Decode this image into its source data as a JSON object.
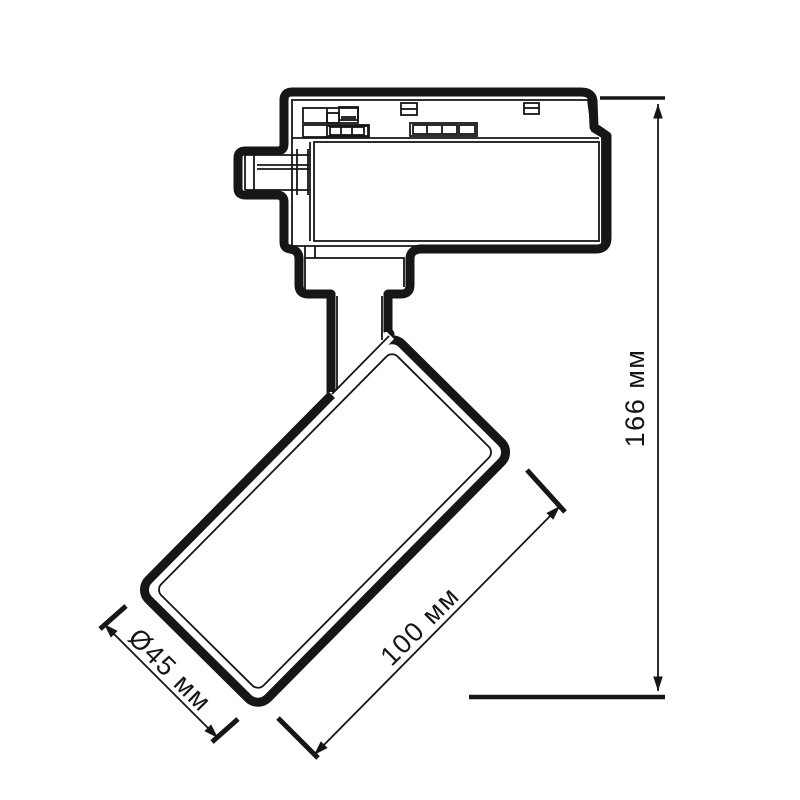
{
  "title": "Track spotlight technical drawing",
  "colors": {
    "line": "#161616",
    "background": "#ffffff"
  },
  "dimensions": {
    "height": "166 мм",
    "length": "100 мм",
    "diameter": "Ø45 мм"
  }
}
